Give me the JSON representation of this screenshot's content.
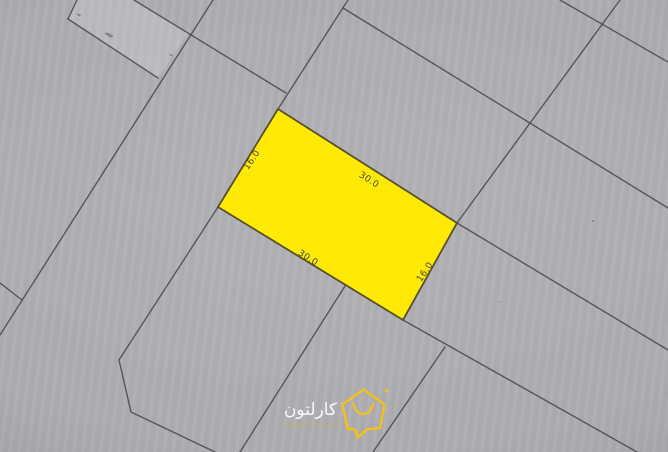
{
  "map": {
    "background_color": "#adacb0",
    "boundary_line_color": "#46464b",
    "plot": {
      "fill_color": "#ffe905",
      "outline_color": "#4a4328",
      "label_color": "#3b392f",
      "dimension_labels": [
        {
          "side": "upper-left",
          "text": "16.0"
        },
        {
          "side": "upper-right",
          "text": "30.0"
        },
        {
          "side": "lower-left",
          "text": "30.0"
        },
        {
          "side": "lower-right",
          "text": "16.0"
        }
      ]
    },
    "watermark": {
      "brand_name_arabic": "كارلتون",
      "tagline": "CARLTON REAL ESTATE",
      "logo_color": "#f2c21a",
      "brand_text_color": "#ffffff"
    }
  }
}
